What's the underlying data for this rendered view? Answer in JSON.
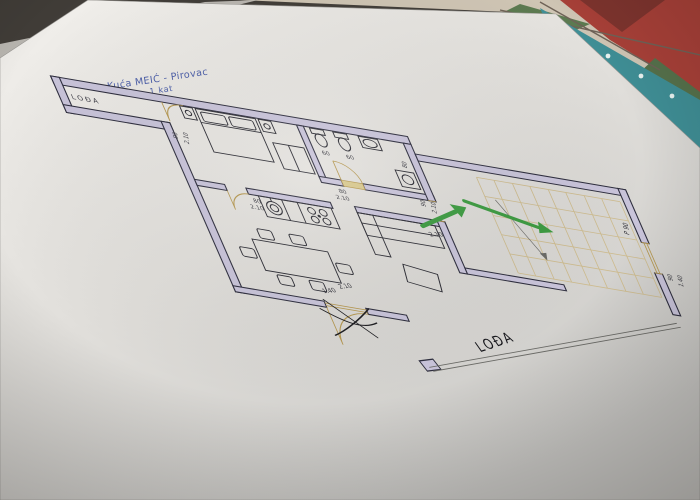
{
  "title_block": {
    "project": "Kuća MEIĆ - Pirovac",
    "floor": "1 kat"
  },
  "room_labels": {
    "loggia_top": "LOĐA",
    "loggia_bottom": "LOĐA"
  },
  "dimensions": {
    "loggia_door": {
      "width": "90",
      "height": "2.10"
    },
    "bedroom_door": {
      "width": "80",
      "height": "2.10"
    },
    "bathroom_door": {
      "width": "80",
      "height": "2.10"
    },
    "bathroom_fixture_a": "60",
    "bathroom_fixture_b": "60",
    "bathroom_side": "80",
    "hall_passage": {
      "width": "90",
      "height": "2.10"
    },
    "arrow_clearance": "2.10",
    "balcony_door": {
      "width": "1.40",
      "height": "2.10"
    },
    "right_window": {
      "label": "P 90",
      "width": "90",
      "height": "1.40"
    }
  },
  "colors": {
    "wall_fill": "#c9c4da",
    "ink": "#2e2e3e",
    "door_tan": "#b5974f",
    "stair_grid": "#cdbb8e",
    "arrow_green": "#3d9b41",
    "title_blue": "#4a5da8",
    "paper": "#e8e6e2",
    "tablecloth_red": "#a84038",
    "tablecloth_green": "#5c7a50",
    "teal_edge": "#3f8e95"
  }
}
